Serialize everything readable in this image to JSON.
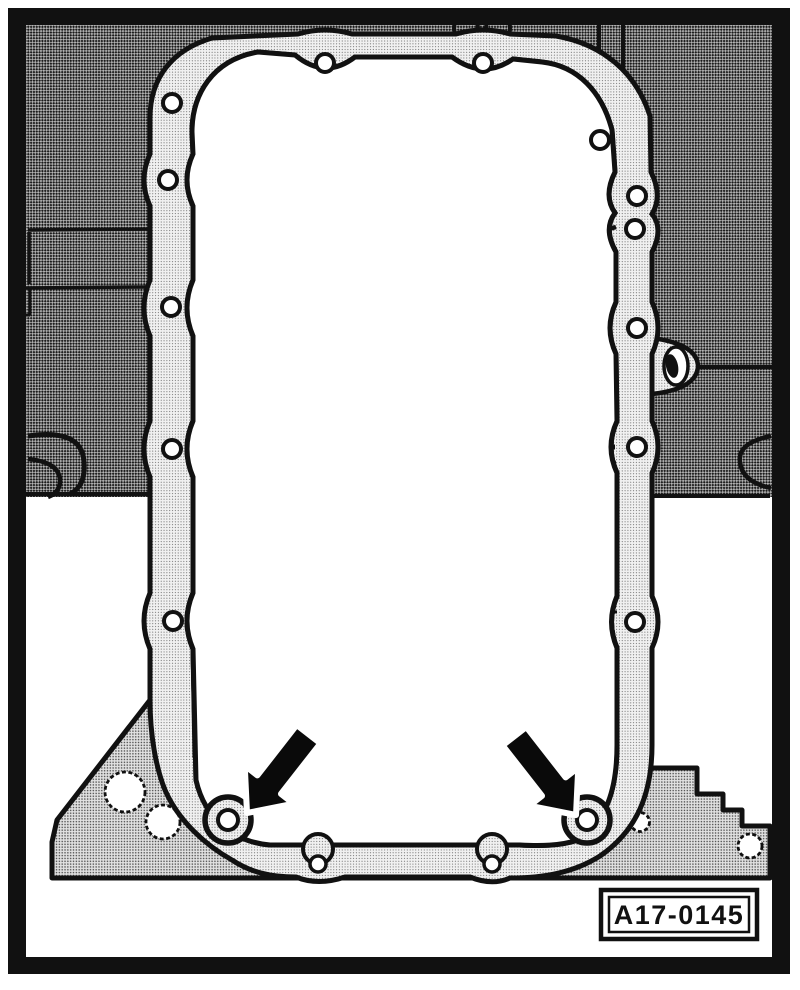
{
  "figure": {
    "caption_label": "A17-0145"
  },
  "colors": {
    "ink": "#111111",
    "paper": "#ffffff",
    "engine_block_halftone_avg": "#8f8f8f",
    "oil_pan_halftone_avg": "#878787",
    "flange_halftone_avg": "#d6d6d6",
    "gasket_surface_halftone_avg": "#ebebeb",
    "arrow_fill": "#0a0a0a"
  },
  "icons": {
    "left_pointer": "pointer-arrow-down-left",
    "right_pointer": "pointer-arrow-down-right"
  }
}
